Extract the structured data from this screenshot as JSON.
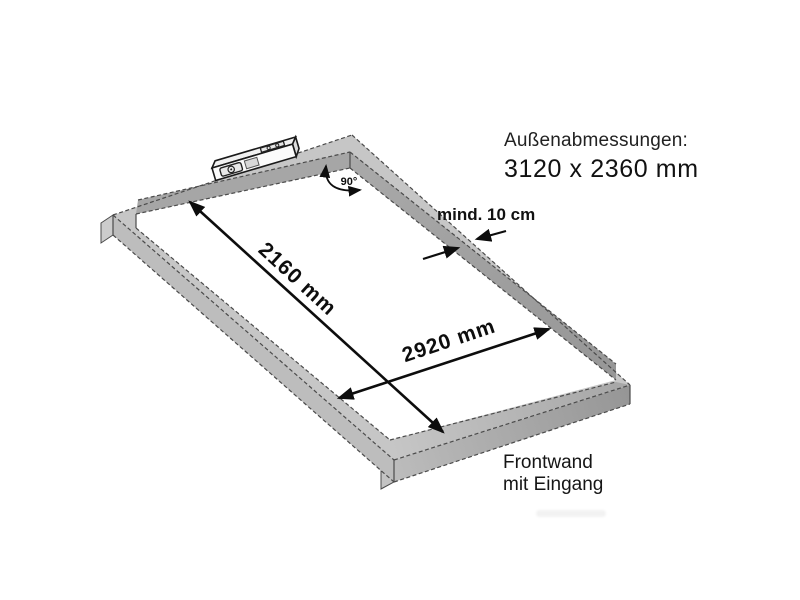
{
  "labels": {
    "outer_dims_title": "Außenabmessungen:",
    "outer_dims_value": "3120 x 2360 mm",
    "inner_width": "2160 mm",
    "inner_length": "2920 mm",
    "min_rail_width": "mind. 10 cm",
    "corner_angle": "90°",
    "front_wall_line1": "Frontwand",
    "front_wall_line2": "mit Eingang"
  },
  "icons": [
    {
      "name": "spirit-level-icon",
      "meaning": "spirit level lying on rear frame rail"
    },
    {
      "name": "angle-arc-icon",
      "meaning": "curved double arrow marking the 90° corner"
    }
  ],
  "colors": {
    "background": "#ffffff",
    "frame_top": "#c6c6c6",
    "frame_inner_face": "#a6a6a6",
    "frame_side_left": "#bdbdbd",
    "frame_side_right_start": "#bcbcbc",
    "frame_side_right_end": "#969696",
    "edge_line": "#4b4b4b",
    "annotation": "#111111"
  }
}
